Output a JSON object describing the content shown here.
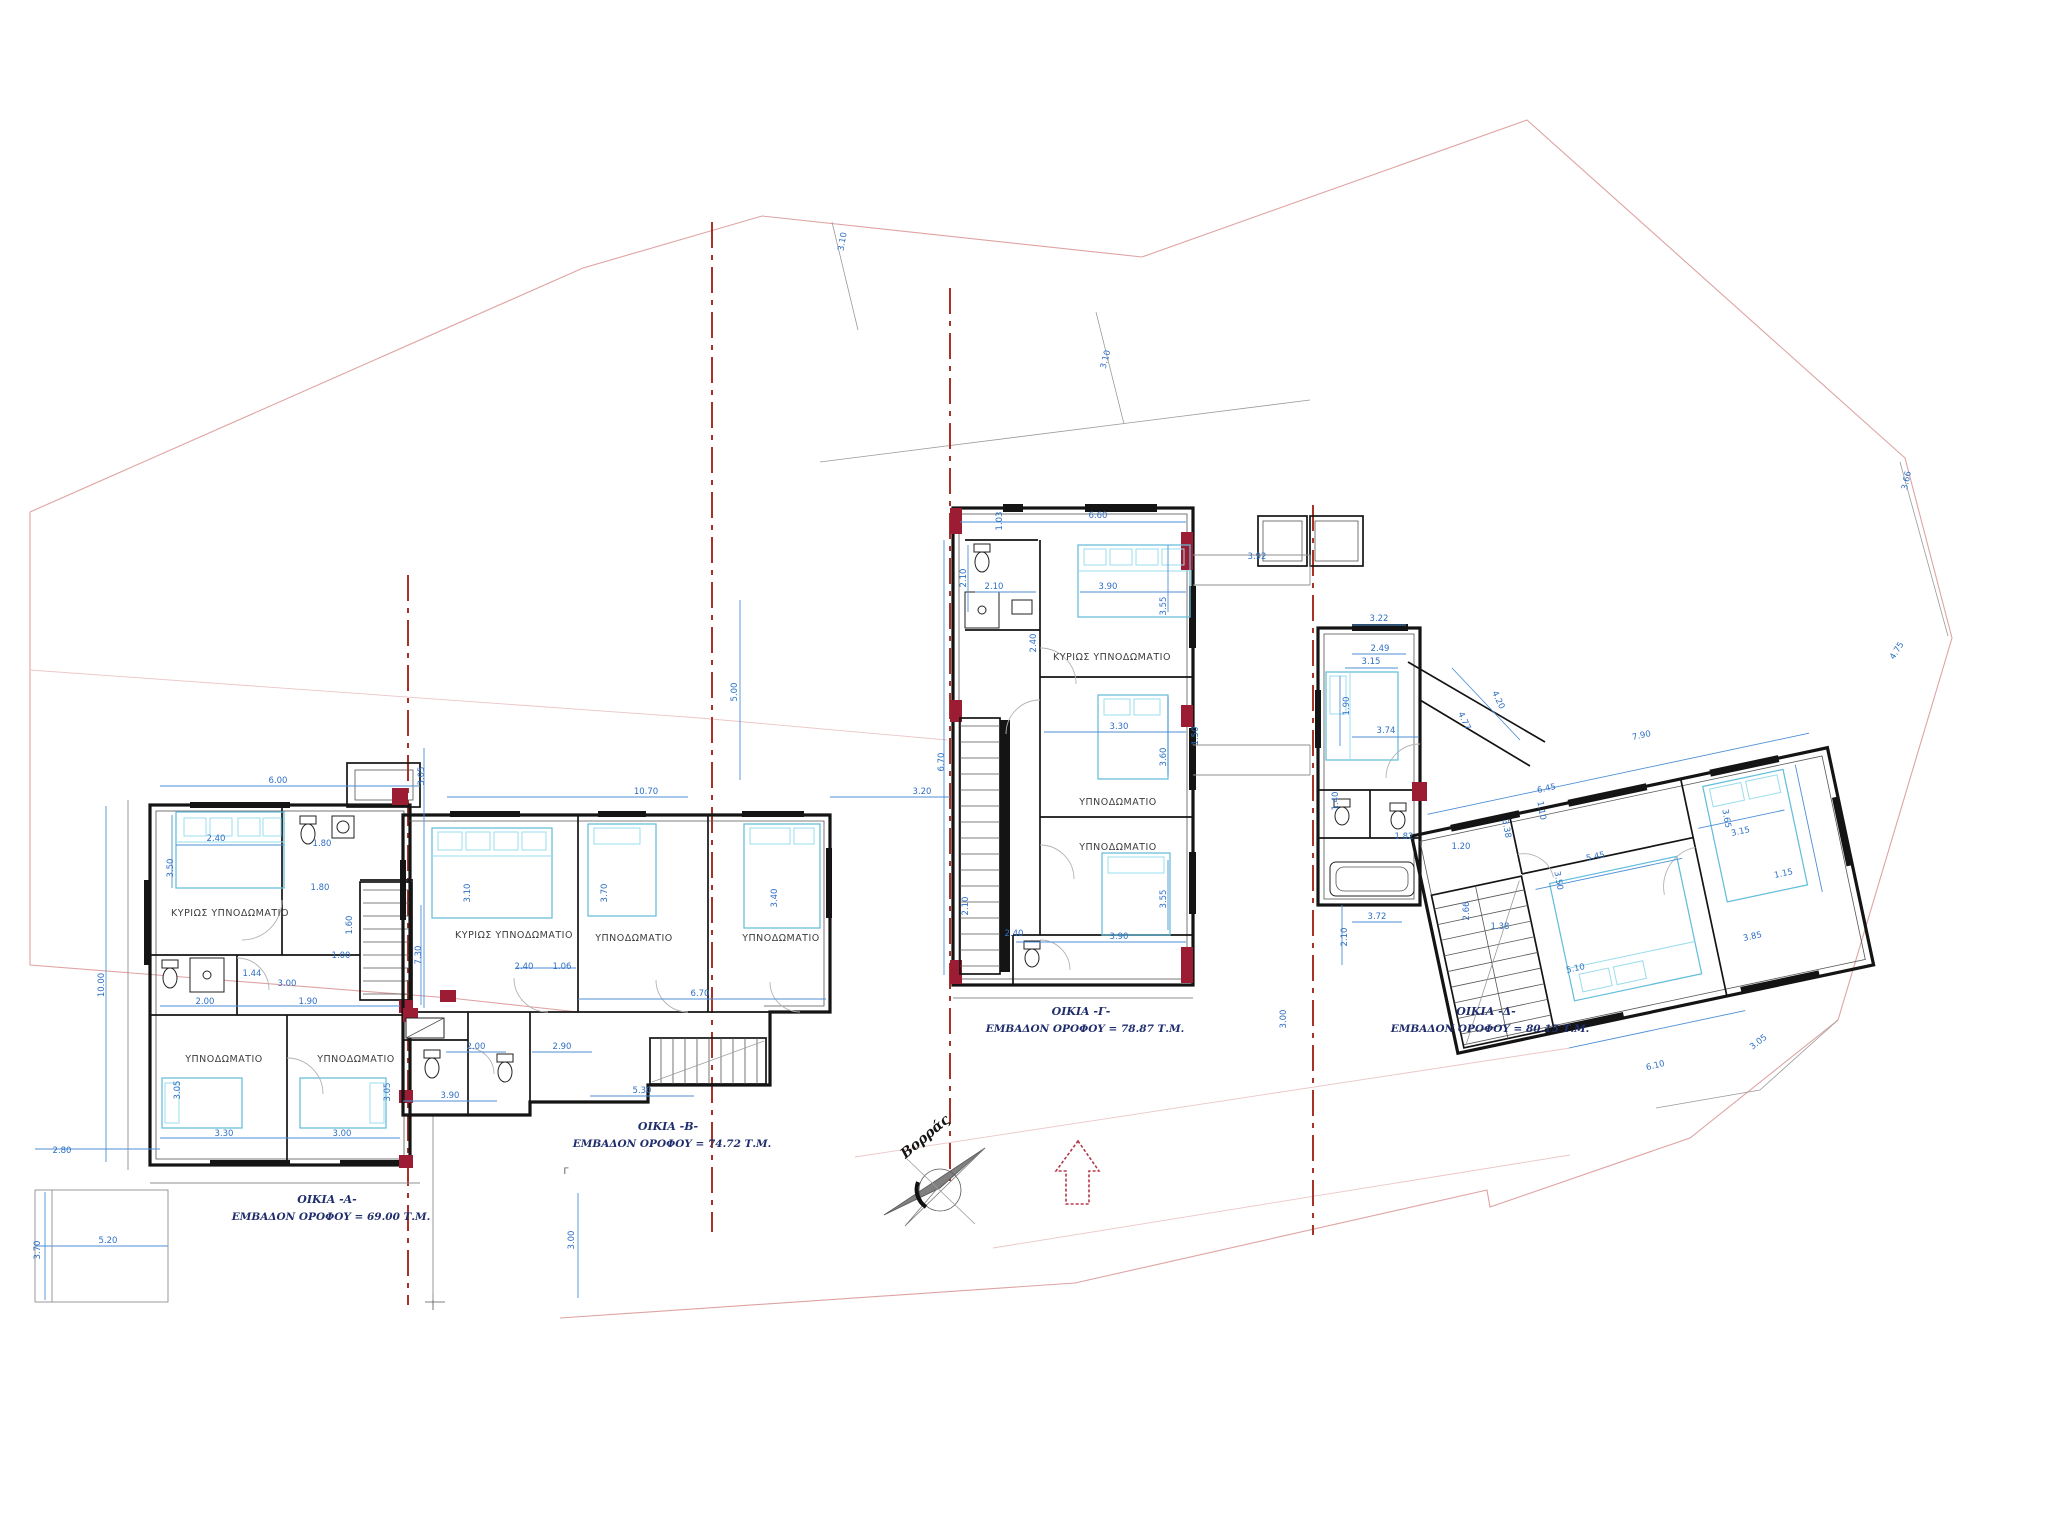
{
  "drawing": {
    "compass": {
      "label": "Βορράς"
    },
    "colors": {
      "walls": "#141414",
      "furniture": "#63bedb",
      "dimensions": "#2e6fc4",
      "section_lines": "#a93226",
      "maroon_walls": "#9c1c33",
      "site_boundary": "#dfa3a3",
      "titles": "#1f2d6b"
    },
    "houses": [
      {
        "name": "ΟΙΚΙΑ -Α-",
        "area": "ΕΜΒΑΔΟΝ ΟΡΟΦΟΥ = 69.00 Τ.Μ.",
        "tx": 327,
        "ty": 1203
      },
      {
        "name": "ΟΙΚΙΑ -Β-",
        "area": "ΕΜΒΑΔΟΝ ΟΡΟΦΟΥ = 74.72 Τ.Μ.",
        "tx": 668,
        "ty": 1130
      },
      {
        "name": "ΟΙΚΙΑ -Γ-",
        "area": "ΕΜΒΑΔΟΝ ΟΡΟΦΟΥ = 78.87 Τ.Μ.",
        "tx": 1081,
        "ty": 1015
      },
      {
        "name": "ΟΙΚΙΑ -Δ-",
        "area": "ΕΜΒΑΔΟΝ ΟΡΟΦΟΥ = 80.15 Τ.Μ.",
        "tx": 1486,
        "ty": 1015
      }
    ],
    "rooms": [
      {
        "label": "ΚΥΡΙΩΣ ΥΠΝΟΔΩΜΑΤΙΟ",
        "x": 230,
        "y": 916
      },
      {
        "label": "ΥΠΝΟΔΩΜΑΤΙΟ",
        "x": 224,
        "y": 1062
      },
      {
        "label": "ΥΠΝΟΔΩΜΑΤΙΟ",
        "x": 356,
        "y": 1062
      },
      {
        "label": "ΚΥΡΙΩΣ ΥΠΝΟΔΩΜΑΤΙΟ",
        "x": 514,
        "y": 938
      },
      {
        "label": "ΥΠΝΟΔΩΜΑΤΙΟ",
        "x": 634,
        "y": 941
      },
      {
        "label": "ΥΠΝΟΔΩΜΑΤΙΟ",
        "x": 781,
        "y": 941
      },
      {
        "label": "ΚΥΡΙΩΣ ΥΠΝΟΔΩΜΑΤΙΟ",
        "x": 1112,
        "y": 660
      },
      {
        "label": "ΥΠΝΟΔΩΜΑΤΙΟ",
        "x": 1118,
        "y": 805
      },
      {
        "label": "ΥΠΝΟΔΩΜΑΤΙΟ",
        "x": 1118,
        "y": 850
      }
    ],
    "section_mark": "Γ",
    "dimensions": [
      {
        "t": "6.00",
        "x": 278,
        "y": 783
      },
      {
        "t": "2.40",
        "x": 216,
        "y": 841
      },
      {
        "t": "3.50",
        "x": 173,
        "y": 868,
        "r": -90
      },
      {
        "t": "1.80",
        "x": 322,
        "y": 846
      },
      {
        "t": "1.80",
        "x": 320,
        "y": 890
      },
      {
        "t": "1.60",
        "x": 352,
        "y": 925,
        "r": -90
      },
      {
        "t": "1.44",
        "x": 252,
        "y": 976
      },
      {
        "t": "3.00",
        "x": 287,
        "y": 986
      },
      {
        "t": "1.00",
        "x": 341,
        "y": 958
      },
      {
        "t": "10.00",
        "x": 104,
        "y": 985,
        "r": -90
      },
      {
        "t": "2.00",
        "x": 205,
        "y": 1004
      },
      {
        "t": "1.90",
        "x": 308,
        "y": 1004
      },
      {
        "t": "3.05",
        "x": 180,
        "y": 1090,
        "r": -90
      },
      {
        "t": "3.05",
        "x": 390,
        "y": 1092,
        "r": -90
      },
      {
        "t": "3.30",
        "x": 224,
        "y": 1136
      },
      {
        "t": "3.00",
        "x": 342,
        "y": 1136
      },
      {
        "t": "2.80",
        "x": 62,
        "y": 1153
      },
      {
        "t": "5.20",
        "x": 108,
        "y": 1243
      },
      {
        "t": "3.70",
        "x": 40,
        "y": 1250,
        "r": -90
      },
      {
        "t": "3.05",
        "x": 424,
        "y": 776,
        "r": -90
      },
      {
        "t": "10.70",
        "x": 646,
        "y": 794
      },
      {
        "t": "3.20",
        "x": 922,
        "y": 794
      },
      {
        "t": "3.10",
        "x": 470,
        "y": 893,
        "r": -90
      },
      {
        "t": "3.70",
        "x": 607,
        "y": 893,
        "r": -90
      },
      {
        "t": "3.40",
        "x": 777,
        "y": 898,
        "r": -90
      },
      {
        "t": "2.40",
        "x": 524,
        "y": 969
      },
      {
        "t": "1.06",
        "x": 562,
        "y": 969
      },
      {
        "t": "7.30",
        "x": 421,
        "y": 955,
        "r": -90
      },
      {
        "t": "6.70",
        "x": 700,
        "y": 996
      },
      {
        "t": "2.00",
        "x": 476,
        "y": 1049
      },
      {
        "t": "2.90",
        "x": 562,
        "y": 1049
      },
      {
        "t": "3.90",
        "x": 450,
        "y": 1098
      },
      {
        "t": "5.30",
        "x": 642,
        "y": 1093
      },
      {
        "t": "3.00",
        "x": 574,
        "y": 1240,
        "r": -90
      },
      {
        "t": "3.10",
        "x": 845,
        "y": 242,
        "r": -80
      },
      {
        "t": "3.10",
        "x": 1108,
        "y": 360,
        "r": -75
      },
      {
        "t": "6.60",
        "x": 1098,
        "y": 518
      },
      {
        "t": "1.03",
        "x": 1002,
        "y": 521,
        "r": -90
      },
      {
        "t": "2.10",
        "x": 966,
        "y": 578,
        "r": -90
      },
      {
        "t": "2.10",
        "x": 994,
        "y": 589
      },
      {
        "t": "3.90",
        "x": 1108,
        "y": 589
      },
      {
        "t": "3.55",
        "x": 1166,
        "y": 606,
        "r": -90
      },
      {
        "t": "2.40",
        "x": 1036,
        "y": 643,
        "r": -90
      },
      {
        "t": "5.00",
        "x": 737,
        "y": 692,
        "r": -90
      },
      {
        "t": "6.70",
        "x": 944,
        "y": 762,
        "r": -90
      },
      {
        "t": "3.30",
        "x": 1119,
        "y": 729
      },
      {
        "t": "3.60",
        "x": 1166,
        "y": 757,
        "r": -90
      },
      {
        "t": "1.50",
        "x": 1198,
        "y": 736,
        "r": -90
      },
      {
        "t": "3.55",
        "x": 1166,
        "y": 899,
        "r": -90
      },
      {
        "t": "2.40",
        "x": 1014,
        "y": 936
      },
      {
        "t": "3.90",
        "x": 1119,
        "y": 939
      },
      {
        "t": "2.10",
        "x": 968,
        "y": 906,
        "r": -90
      },
      {
        "t": "3.92",
        "x": 1257,
        "y": 559
      },
      {
        "t": "3.22",
        "x": 1379,
        "y": 621
      },
      {
        "t": "2.49",
        "x": 1380,
        "y": 651
      },
      {
        "t": "3.15",
        "x": 1371,
        "y": 664
      },
      {
        "t": "1.90",
        "x": 1349,
        "y": 706,
        "r": -90
      },
      {
        "t": "3.74",
        "x": 1386,
        "y": 733
      },
      {
        "t": "4.20",
        "x": 1496,
        "y": 701,
        "r": 65
      },
      {
        "t": "4.77",
        "x": 1462,
        "y": 722,
        "r": 65
      },
      {
        "t": "7.90",
        "x": 1642,
        "y": 738,
        "r": -12
      },
      {
        "t": "6.45",
        "x": 1547,
        "y": 791,
        "r": -12
      },
      {
        "t": "1.10",
        "x": 1539,
        "y": 811,
        "r": 80
      },
      {
        "t": "5.45",
        "x": 1596,
        "y": 859,
        "r": -12
      },
      {
        "t": "3.15",
        "x": 1741,
        "y": 834,
        "r": -12
      },
      {
        "t": "3.65",
        "x": 1724,
        "y": 819,
        "r": 80
      },
      {
        "t": "1.15",
        "x": 1784,
        "y": 876,
        "r": -12
      },
      {
        "t": "3.50",
        "x": 1556,
        "y": 881,
        "r": 80
      },
      {
        "t": "3.38",
        "x": 1504,
        "y": 829,
        "r": 80
      },
      {
        "t": "1.40",
        "x": 1338,
        "y": 801,
        "r": -90
      },
      {
        "t": "1.82",
        "x": 1404,
        "y": 839
      },
      {
        "t": "1.20",
        "x": 1461,
        "y": 849
      },
      {
        "t": "2.10",
        "x": 1347,
        "y": 937,
        "r": -90
      },
      {
        "t": "3.72",
        "x": 1377,
        "y": 919
      },
      {
        "t": "2.66",
        "x": 1469,
        "y": 911,
        "r": -90
      },
      {
        "t": "1.38",
        "x": 1500,
        "y": 929
      },
      {
        "t": "5.10",
        "x": 1576,
        "y": 971,
        "r": -12
      },
      {
        "t": "3.85",
        "x": 1753,
        "y": 939,
        "r": -12
      },
      {
        "t": "6.10",
        "x": 1656,
        "y": 1068,
        "r": -14
      },
      {
        "t": "3.05",
        "x": 1760,
        "y": 1044,
        "r": -38
      },
      {
        "t": "3.00",
        "x": 1286,
        "y": 1019,
        "r": -90
      },
      {
        "t": "3.66",
        "x": 1909,
        "y": 481,
        "r": -78
      },
      {
        "t": "4.75",
        "x": 1899,
        "y": 652,
        "r": -58
      }
    ]
  }
}
